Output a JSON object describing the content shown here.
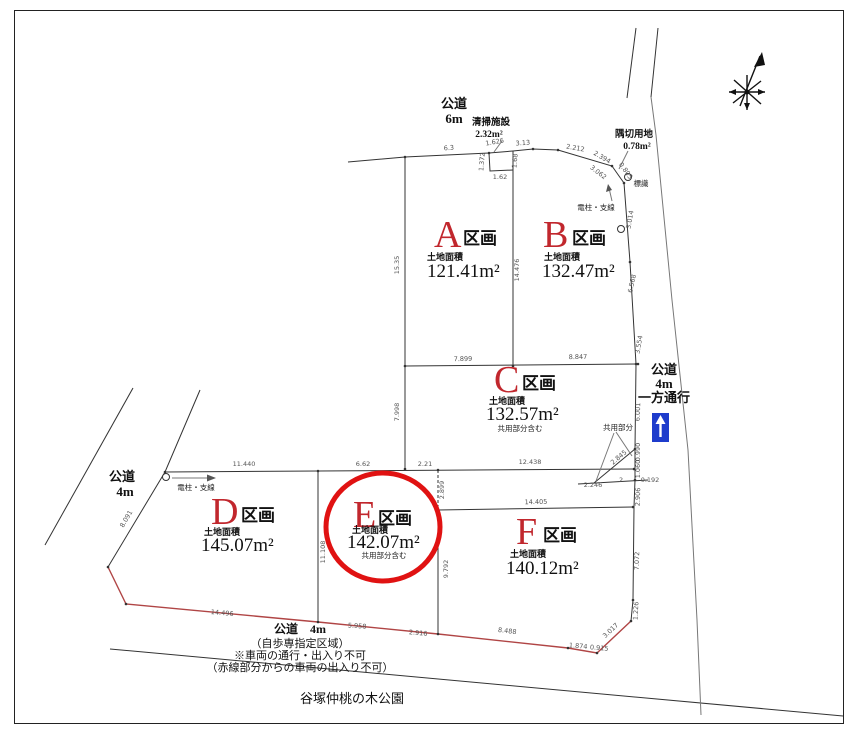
{
  "drawing": {
    "roads": {
      "top": {
        "label": "公道",
        "width": "6m"
      },
      "left": {
        "label": "公道",
        "width": "4m"
      },
      "right": {
        "label": "公道",
        "width": "4m",
        "note": "一方通行"
      },
      "bottom": {
        "label": "公道　4m",
        "notes": [
          "（自歩専指定区域）",
          "※車両の通行・出入り不可",
          "（赤線部分からの車両の出入り不可）"
        ]
      }
    },
    "park_label": "谷塚仲桃の木公園",
    "annotations": {
      "cleaning_facility": {
        "label": "清掃施設",
        "area": "2.32m²"
      },
      "corner_lot": {
        "label": "隅切用地",
        "area": "0.78m²"
      },
      "sign_label": "標識",
      "pole_right": "電柱・支線",
      "pole_left": "電柱・支線",
      "shared_section": "共用部分"
    },
    "plots": [
      {
        "id": "A",
        "suffix": "区画",
        "area_title": "土地面積",
        "area": "121.41m²"
      },
      {
        "id": "B",
        "suffix": "区画",
        "area_title": "土地面積",
        "area": "132.47m²"
      },
      {
        "id": "C",
        "suffix": "区画",
        "area_title": "土地面積",
        "area": "132.57m²",
        "note": "共用部分含む"
      },
      {
        "id": "D",
        "suffix": "区画",
        "area_title": "土地面積",
        "area": "145.07m²"
      },
      {
        "id": "E",
        "suffix": "区画",
        "area_title": "土地面積",
        "area": "142.07m²",
        "note": "共用部分含む",
        "highlighted": true
      },
      {
        "id": "F",
        "suffix": "区画",
        "area_title": "土地面積",
        "area": "140.12m²"
      }
    ],
    "dimensions": [
      {
        "t": "6.3",
        "x": 449,
        "y": 150,
        "r": -4
      },
      {
        "t": "1.626",
        "x": 495,
        "y": 144,
        "r": -10
      },
      {
        "t": "3.13",
        "x": 523,
        "y": 145,
        "r": -4
      },
      {
        "t": "2.212",
        "x": 575,
        "y": 150,
        "r": 10
      },
      {
        "t": "2.394",
        "x": 601,
        "y": 159,
        "r": 30
      },
      {
        "t": "3.062",
        "x": 597,
        "y": 174,
        "r": 38
      },
      {
        "t": "0.805",
        "x": 624,
        "y": 172,
        "r": 55
      },
      {
        "t": "1.372",
        "x": 484,
        "y": 162,
        "r": -85
      },
      {
        "t": "1.68",
        "x": 517,
        "y": 161,
        "r": -85
      },
      {
        "t": "1.62",
        "x": 500,
        "y": 179,
        "r": 0
      },
      {
        "t": "3.014",
        "x": 632,
        "y": 220,
        "r": -80
      },
      {
        "t": "15.35",
        "x": 399,
        "y": 265,
        "r": -90
      },
      {
        "t": "14.476",
        "x": 519,
        "y": 270,
        "r": -90
      },
      {
        "t": "6.568",
        "x": 634,
        "y": 284,
        "r": -78
      },
      {
        "t": "7.899",
        "x": 463,
        "y": 361,
        "r": -1
      },
      {
        "t": "8.847",
        "x": 578,
        "y": 359,
        "r": -1
      },
      {
        "t": "3.554",
        "x": 641,
        "y": 345,
        "r": -80
      },
      {
        "t": "7.998",
        "x": 399,
        "y": 412,
        "r": -90
      },
      {
        "t": "6.001",
        "x": 640,
        "y": 412,
        "r": -88
      },
      {
        "t": "2.845",
        "x": 620,
        "y": 459,
        "r": -40
      },
      {
        "t": "0.990",
        "x": 640,
        "y": 452,
        "r": -90
      },
      {
        "t": "1.060",
        "x": 640,
        "y": 469,
        "r": -90
      },
      {
        "t": "2.246",
        "x": 593,
        "y": 487,
        "r": 0
      },
      {
        "t": "2",
        "x": 621,
        "y": 482,
        "r": 0
      },
      {
        "t": "0.192",
        "x": 650,
        "y": 482,
        "r": 0
      },
      {
        "t": "2.906",
        "x": 640,
        "y": 497,
        "r": -88
      },
      {
        "t": "11.440",
        "x": 244,
        "y": 466,
        "r": 0
      },
      {
        "t": "6.62",
        "x": 363,
        "y": 466,
        "r": 0
      },
      {
        "t": "2.21",
        "x": 425,
        "y": 466,
        "r": 0
      },
      {
        "t": "12.438",
        "x": 530,
        "y": 464,
        "r": 0
      },
      {
        "t": "2.899",
        "x": 444,
        "y": 490,
        "r": -90
      },
      {
        "t": "14.405",
        "x": 536,
        "y": 504,
        "r": -1
      },
      {
        "t": "8.091",
        "x": 128,
        "y": 520,
        "r": -60
      },
      {
        "t": "11.108",
        "x": 325,
        "y": 552,
        "r": -90
      },
      {
        "t": "9.792",
        "x": 448,
        "y": 569,
        "r": -90
      },
      {
        "t": "7.072",
        "x": 639,
        "y": 561,
        "r": -88
      },
      {
        "t": "1.226",
        "x": 638,
        "y": 611,
        "r": -87
      },
      {
        "t": "14.496",
        "x": 222,
        "y": 615,
        "r": 5
      },
      {
        "t": "5.958",
        "x": 357,
        "y": 628,
        "r": 4
      },
      {
        "t": "2.916",
        "x": 418,
        "y": 635,
        "r": 5
      },
      {
        "t": "8.488",
        "x": 507,
        "y": 633,
        "r": 7
      },
      {
        "t": "1.874",
        "x": 578,
        "y": 648,
        "r": 5
      },
      {
        "t": "0.915",
        "x": 599,
        "y": 650,
        "r": 5
      },
      {
        "t": "3.017",
        "x": 612,
        "y": 632,
        "r": -43
      }
    ],
    "colors": {
      "plot_letter": "#c1272d",
      "highlight": "#e01212",
      "red_boundary": "#b04545",
      "oneway_blue": "#1e3ccc",
      "line": "#333333",
      "dim_text": "#555555"
    }
  }
}
